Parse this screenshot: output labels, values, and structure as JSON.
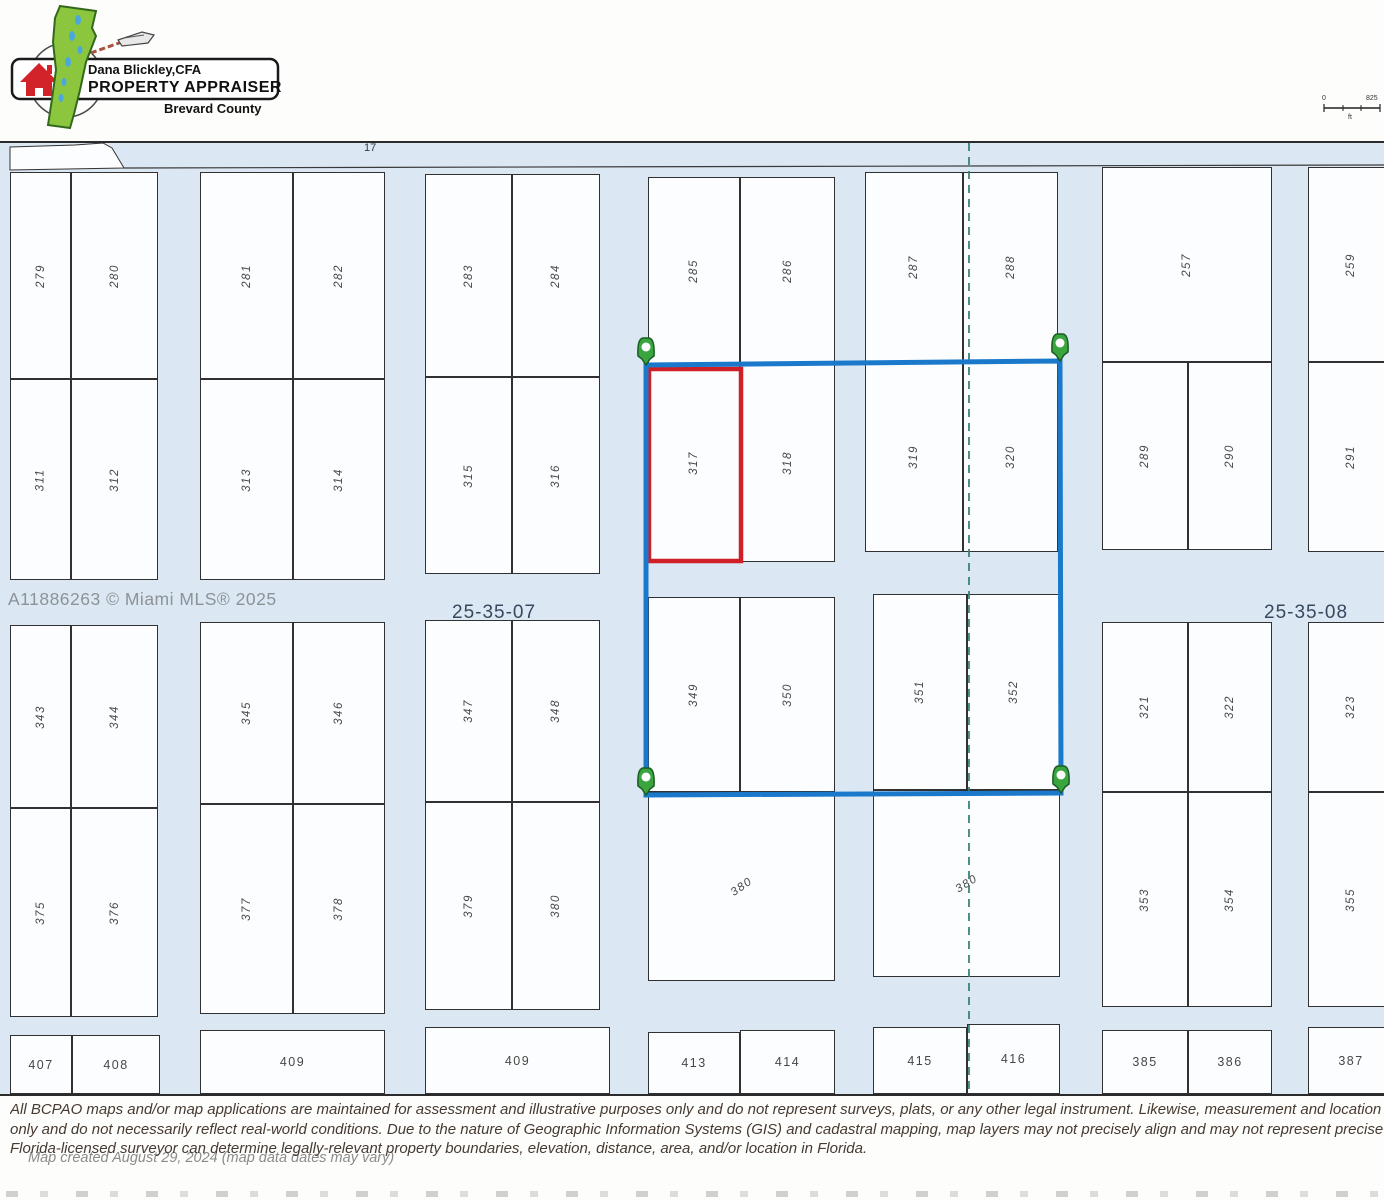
{
  "logo": {
    "appraiser_name": "Dana Blickley,CFA",
    "appraiser_title": "PROPERTY APPRAISER",
    "county": "Brevard County"
  },
  "scalebar": {
    "zero": "0",
    "distance": "825",
    "unit": "ft"
  },
  "map": {
    "road_label": "17",
    "section_left": "25-35-07",
    "section_right": "25-35-08",
    "watermark": "A11886263 © Miami MLS® 2025",
    "selected_parcel": "317",
    "parcels": [
      {
        "label": "279",
        "x": 10,
        "y": 170,
        "w": 61,
        "h": 207,
        "rot": -90
      },
      {
        "label": "280",
        "x": 71,
        "y": 170,
        "w": 87,
        "h": 207,
        "rot": -90
      },
      {
        "label": "281",
        "x": 200,
        "y": 170,
        "w": 93,
        "h": 207,
        "rot": -90
      },
      {
        "label": "282",
        "x": 293,
        "y": 170,
        "w": 92,
        "h": 207,
        "rot": -90
      },
      {
        "label": "283",
        "x": 425,
        "y": 172,
        "w": 87,
        "h": 203,
        "rot": -90
      },
      {
        "label": "284",
        "x": 512,
        "y": 172,
        "w": 88,
        "h": 203,
        "rot": -90
      },
      {
        "label": "285",
        "x": 648,
        "y": 175,
        "w": 92,
        "h": 187,
        "rot": -90
      },
      {
        "label": "286",
        "x": 740,
        "y": 175,
        "w": 95,
        "h": 187,
        "rot": -90
      },
      {
        "label": "287",
        "x": 865,
        "y": 170,
        "w": 98,
        "h": 190,
        "rot": -90
      },
      {
        "label": "288",
        "x": 963,
        "y": 170,
        "w": 95,
        "h": 190,
        "rot": -90
      },
      {
        "label": "257",
        "x": 1102,
        "y": 165,
        "w": 170,
        "h": 195,
        "rot": -90
      },
      {
        "label": "259",
        "x": 1308,
        "y": 165,
        "w": 86,
        "h": 195,
        "rot": -90
      },
      {
        "label": "311",
        "x": 10,
        "y": 377,
        "w": 61,
        "h": 201,
        "rot": -90
      },
      {
        "label": "312",
        "x": 71,
        "y": 377,
        "w": 87,
        "h": 201,
        "rot": -90
      },
      {
        "label": "313",
        "x": 200,
        "y": 377,
        "w": 93,
        "h": 201,
        "rot": -90
      },
      {
        "label": "314",
        "x": 293,
        "y": 377,
        "w": 92,
        "h": 201,
        "rot": -90
      },
      {
        "label": "315",
        "x": 425,
        "y": 375,
        "w": 87,
        "h": 197,
        "rot": -90
      },
      {
        "label": "316",
        "x": 512,
        "y": 375,
        "w": 88,
        "h": 197,
        "rot": -90
      },
      {
        "label": "317",
        "x": 648,
        "y": 362,
        "w": 92,
        "h": 198,
        "rot": -90
      },
      {
        "label": "318",
        "x": 740,
        "y": 362,
        "w": 95,
        "h": 198,
        "rot": -90
      },
      {
        "label": "319",
        "x": 865,
        "y": 360,
        "w": 98,
        "h": 190,
        "rot": -90
      },
      {
        "label": "320",
        "x": 963,
        "y": 360,
        "w": 95,
        "h": 190,
        "rot": -90
      },
      {
        "label": "289",
        "x": 1102,
        "y": 360,
        "w": 86,
        "h": 188,
        "rot": -90
      },
      {
        "label": "290",
        "x": 1188,
        "y": 360,
        "w": 84,
        "h": 188,
        "rot": -90
      },
      {
        "label": "291",
        "x": 1308,
        "y": 360,
        "w": 86,
        "h": 190,
        "rot": -90
      },
      {
        "label": "343",
        "x": 10,
        "y": 623,
        "w": 61,
        "h": 183,
        "rot": -90
      },
      {
        "label": "344",
        "x": 71,
        "y": 623,
        "w": 87,
        "h": 183,
        "rot": -90
      },
      {
        "label": "345",
        "x": 200,
        "y": 620,
        "w": 93,
        "h": 182,
        "rot": -90
      },
      {
        "label": "346",
        "x": 293,
        "y": 620,
        "w": 92,
        "h": 182,
        "rot": -90
      },
      {
        "label": "347",
        "x": 425,
        "y": 618,
        "w": 87,
        "h": 182,
        "rot": -90
      },
      {
        "label": "348",
        "x": 512,
        "y": 618,
        "w": 88,
        "h": 182,
        "rot": -90
      },
      {
        "label": "349",
        "x": 648,
        "y": 595,
        "w": 92,
        "h": 195,
        "rot": -90
      },
      {
        "label": "350",
        "x": 740,
        "y": 595,
        "w": 95,
        "h": 195,
        "rot": -90
      },
      {
        "label": "351",
        "x": 873,
        "y": 592,
        "w": 94,
        "h": 196,
        "rot": -90
      },
      {
        "label": "352",
        "x": 967,
        "y": 592,
        "w": 93,
        "h": 196,
        "rot": -90
      },
      {
        "label": "321",
        "x": 1102,
        "y": 620,
        "w": 86,
        "h": 170,
        "rot": -90
      },
      {
        "label": "322",
        "x": 1188,
        "y": 620,
        "w": 84,
        "h": 170,
        "rot": -90
      },
      {
        "label": "323",
        "x": 1308,
        "y": 620,
        "w": 86,
        "h": 170,
        "rot": -90
      },
      {
        "label": "375",
        "x": 10,
        "y": 806,
        "w": 61,
        "h": 209,
        "rot": -90
      },
      {
        "label": "376",
        "x": 71,
        "y": 806,
        "w": 87,
        "h": 209,
        "rot": -90
      },
      {
        "label": "377",
        "x": 200,
        "y": 802,
        "w": 93,
        "h": 210,
        "rot": -90
      },
      {
        "label": "378",
        "x": 293,
        "y": 802,
        "w": 92,
        "h": 210,
        "rot": -90
      },
      {
        "label": "379",
        "x": 425,
        "y": 800,
        "w": 87,
        "h": 208,
        "rot": -90
      },
      {
        "label": "380",
        "x": 512,
        "y": 800,
        "w": 88,
        "h": 208,
        "rot": -90
      },
      {
        "label": "380",
        "x": 648,
        "y": 790,
        "w": 187,
        "h": 189,
        "rot": -35
      },
      {
        "label": "380",
        "x": 873,
        "y": 788,
        "w": 187,
        "h": 187,
        "rot": -32
      },
      {
        "label": "353",
        "x": 1102,
        "y": 790,
        "w": 86,
        "h": 215,
        "rot": -90
      },
      {
        "label": "354",
        "x": 1188,
        "y": 790,
        "w": 84,
        "h": 215,
        "rot": -90
      },
      {
        "label": "355",
        "x": 1308,
        "y": 790,
        "w": 86,
        "h": 215,
        "rot": -90
      },
      {
        "label": "407",
        "x": 10,
        "y": 1033,
        "w": 62,
        "h": 59,
        "rot": 0
      },
      {
        "label": "408",
        "x": 72,
        "y": 1033,
        "w": 88,
        "h": 59,
        "rot": 0
      },
      {
        "label": "409",
        "x": 200,
        "y": 1028,
        "w": 185,
        "h": 64,
        "rot": 0
      },
      {
        "label": "409",
        "x": 425,
        "y": 1025,
        "w": 185,
        "h": 67,
        "rot": 0
      },
      {
        "label": "413",
        "x": 648,
        "y": 1030,
        "w": 92,
        "h": 62,
        "rot": 0
      },
      {
        "label": "414",
        "x": 740,
        "y": 1028,
        "w": 95,
        "h": 64,
        "rot": 0
      },
      {
        "label": "415",
        "x": 873,
        "y": 1025,
        "w": 94,
        "h": 67,
        "rot": 0
      },
      {
        "label": "416",
        "x": 967,
        "y": 1022,
        "w": 93,
        "h": 70,
        "rot": 0
      },
      {
        "label": "385",
        "x": 1102,
        "y": 1028,
        "w": 86,
        "h": 64,
        "rot": 0
      },
      {
        "label": "386",
        "x": 1188,
        "y": 1028,
        "w": 84,
        "h": 64,
        "rot": 0
      },
      {
        "label": "387",
        "x": 1308,
        "y": 1025,
        "w": 86,
        "h": 67,
        "rot": 0
      }
    ]
  },
  "colors": {
    "selection_blue": "#1b79cc",
    "highlight_red": "#cf2027",
    "pin_green": "#3aa53f",
    "road_blue": "#dbe7f2",
    "section_line_teal": "#2e7d73"
  },
  "footer": {
    "disclaimer_line1": "All BCPAO maps and/or map applications are maintained for assessment and illustrative purposes only and do not represent surveys, plats, or any other legal instrument. Likewise, measurement and location tools are t",
    "disclaimer_line2": "only and do not necessarily reflect real-world conditions. Due to the nature of Geographic Information Systems (GIS) and cadastral mapping, map layers may not precisely align and may not represent precise location, a",
    "disclaimer_line3": "Florida-licensed surveyor can determine legally-relevant property boundaries, elevation, distance, area, and/or location in Florida.",
    "created": "Map created August 29, 2024 (map data dates may vary)"
  }
}
